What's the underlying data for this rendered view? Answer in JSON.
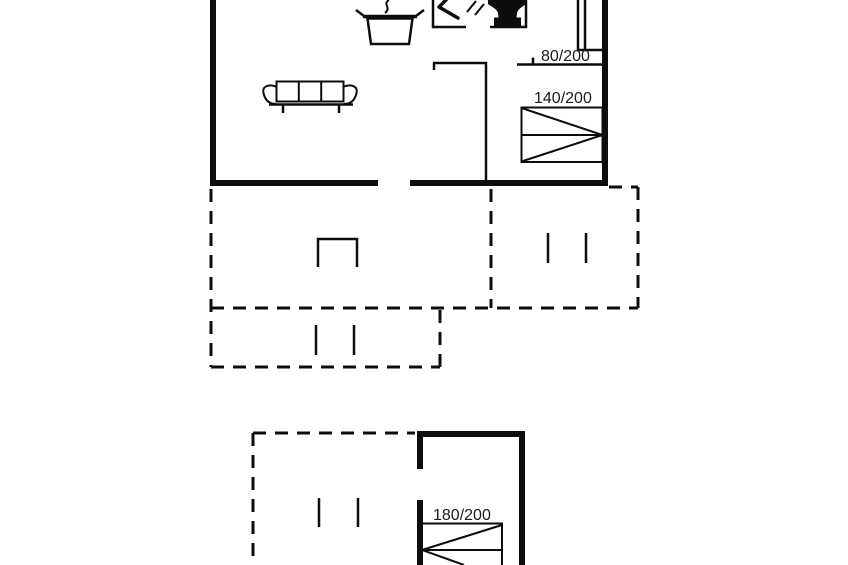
{
  "canvas": {
    "background": "#ffffff",
    "line_color": "#0d0d0d",
    "text_color": "#1a1a1a"
  },
  "plan": {
    "kind": "holiday-home floor plan",
    "beds": [
      {
        "label": "80/200"
      },
      {
        "label": "140/200"
      },
      {
        "label": "180/200"
      }
    ],
    "icons": [
      "sofa-icon",
      "cooking-pot-icon",
      "steam-icon",
      "shower-icon",
      "toilet-icon",
      "double-bed-icon",
      "single-bed-icon",
      "terrace-table-icon",
      "terrace-opening-marks"
    ],
    "areas": {
      "main_house": "solid walls (top)",
      "terrace": "dashed outline (middle)",
      "annex": "solid walls with dashed terrace (bottom)"
    }
  }
}
